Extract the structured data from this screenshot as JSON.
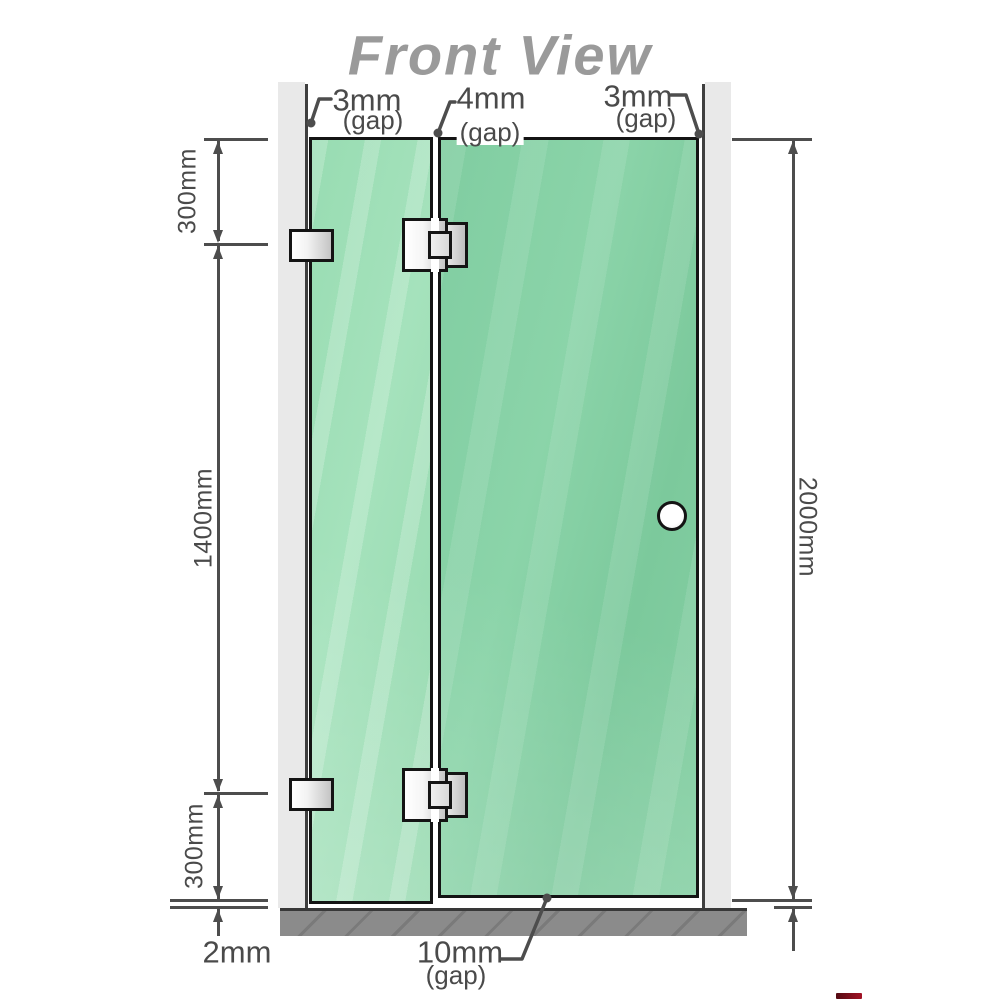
{
  "title": "Front View",
  "heights": {
    "top": "300mm",
    "middle": "1400mm",
    "bottom": "300mm",
    "total": "2000mm",
    "floor_gap": "2mm"
  },
  "gaps": {
    "top_left": {
      "value": "3mm",
      "unit_label": "(gap)"
    },
    "top_middle": {
      "value": "4mm",
      "unit_label": "(gap)"
    },
    "top_right": {
      "value": "3mm",
      "unit_label": "(gap)"
    },
    "bottom": {
      "value": "10mm",
      "unit_label": "(gap)"
    }
  },
  "colors": {
    "glass_fixed": "#9adcb3",
    "glass_door": "#82cda2",
    "wall": "#e9e9e9",
    "wall_edge_line": "#3f3f3f",
    "floor": "#8b8b8b",
    "dimension_line": "#4d4d4d",
    "title_text": "#9a9a9a",
    "hardware_border": "#141414",
    "accent_red": "#8c0f1c"
  }
}
